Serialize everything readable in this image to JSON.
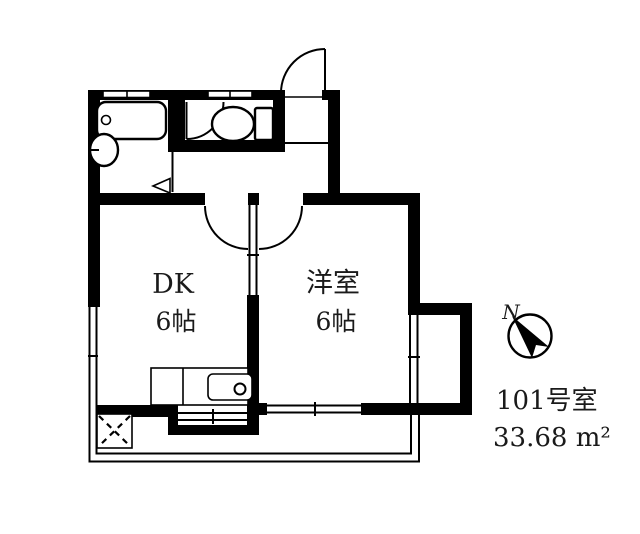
{
  "labels": {
    "dk_name": "DK",
    "dk_size": "6帖",
    "western_room_name": "洋室",
    "western_room_size": "6帖",
    "compass_north": "N",
    "unit_number": "101号室",
    "unit_area": "33.68 m²"
  },
  "fixtures": [
    "bathtub-icon",
    "washbasin-icon",
    "toilet-icon",
    "kitchen-counter",
    "kitchen-sink-icon",
    "washing-machine-space",
    "balcony-outline",
    "compass-icon"
  ],
  "colors": {
    "line": "#000000",
    "background": "#ffffff"
  }
}
